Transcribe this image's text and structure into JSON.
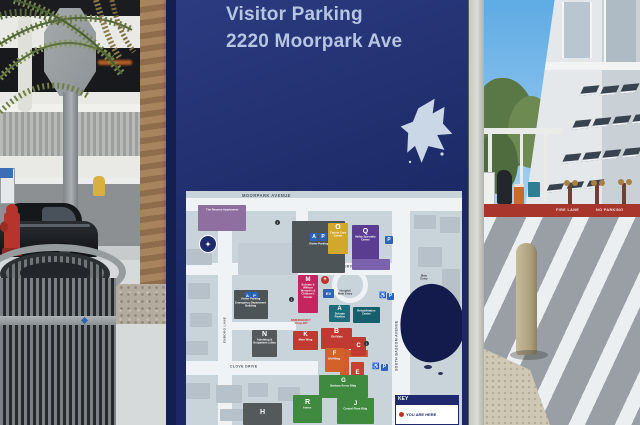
{
  "sign": {
    "title_line1": "Visitor Parking",
    "title_line2": "2220 Moorpark Ave",
    "map": {
      "streets": {
        "moorpark": "MOORPARK AVENUE",
        "bascom": "SOUTH BASCOM AVENUE",
        "renova": "RENOVA DRIVE",
        "clove": "CLOVE DRIVE",
        "enborg": "ENBORG LANE",
        "thayer": "THAYER DRIVE"
      },
      "labels": {
        "emergency_line1": "EMERGENCY",
        "emergency_line2": "Drop-Off",
        "hospital_entry": "Hospital Main Entry",
        "main_entry": "Main Entry"
      },
      "legend": {
        "header": "KEY",
        "you_are_here": "YOU ARE HERE"
      },
      "buildings": [
        {
          "letter": "",
          "name": "The Reserve Apartments",
          "color": "#8e6f9f"
        },
        {
          "letter": "",
          "name": "Visitor Parking",
          "color": "#4d5457"
        },
        {
          "letter": "O",
          "name": "Cancer Care Center",
          "color": "#d2a82c"
        },
        {
          "letter": "Q",
          "name": "Valley Specialty Center",
          "color": "#5a3d90"
        },
        {
          "letter": "M",
          "name": "Sobrato & Willson Women's & Children's Center",
          "color": "#c42460"
        },
        {
          "letter": "A",
          "name": "Sobrato Pavilion",
          "color": "#1e6c79"
        },
        {
          "letter": "",
          "name": "Rehabilitation Center",
          "color": "#155f6d"
        },
        {
          "letter": "",
          "name": "Visitor Parking",
          "name2": "Emergency Department Building",
          "color": "#4d5457"
        },
        {
          "letter": "N",
          "name": "Admitting & Outpatient Lobby",
          "color": "#54595c"
        },
        {
          "letter": "K",
          "name": "Main Wing",
          "color": "#c13a32"
        },
        {
          "letter": "B",
          "name": "Old Main",
          "color": "#c13a32"
        },
        {
          "letter": "C",
          "name": "",
          "color": "#c13a32"
        },
        {
          "letter": "F",
          "name": "Old Wing",
          "color": "#d2622a"
        },
        {
          "letter": "E",
          "name": "",
          "color": "#c8402f"
        },
        {
          "letter": "G",
          "name": "Barbara Arons Bldg",
          "color": "#3f8a3f"
        },
        {
          "letter": "J",
          "name": "Central Plant Bldg",
          "color": "#3f8a3f"
        },
        {
          "letter": "R",
          "name": "Annex",
          "color": "#3f8a3f"
        },
        {
          "letter": "H",
          "name": "",
          "color": "#54595c"
        },
        {
          "letter": "",
          "name": "VHC Bascom",
          "color": "#2aa2ac"
        }
      ]
    }
  },
  "street_scene": {
    "curb_text1": "FIRE LANE",
    "curb_text2": "NO PARKING"
  },
  "icons": {
    "a": "A",
    "p": "P",
    "parking": "P",
    "ev": "EV",
    "info": "i",
    "accessible": "♿",
    "cross": "+"
  },
  "colors": {
    "sign_blue": "#1f2d6e",
    "header_text": "#b5c5e2",
    "map_bg": "#c9d3da",
    "parking_blue": "#2e63b8",
    "corridor_orange": "#cf5b2e",
    "q_ext_purple": "#7a62ad",
    "legend_navy": "#1e2a6d",
    "seal_navy": "#1e2a6d",
    "graffiti_navy": "#131b4c",
    "curb_red": "#a8362c",
    "emergency_red": "#c4332b"
  }
}
